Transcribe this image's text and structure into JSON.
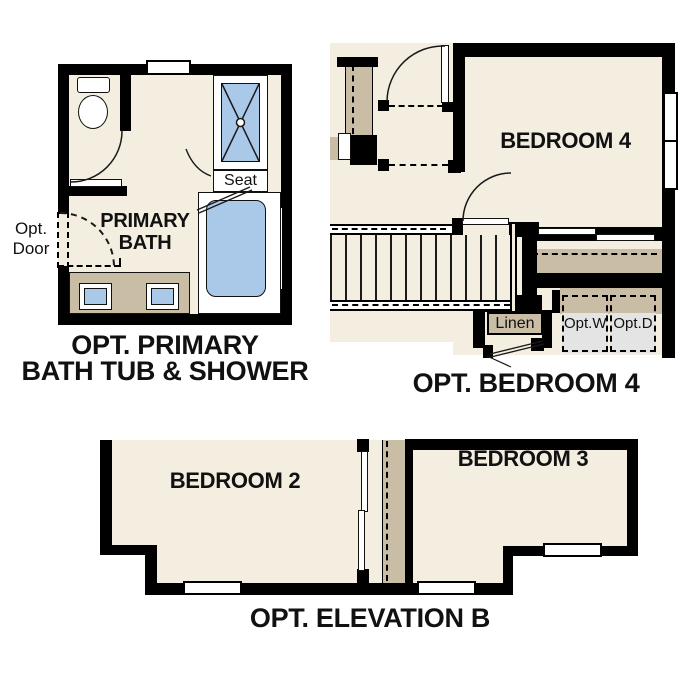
{
  "colors": {
    "floor": "#f4eee1",
    "counter": "#c9bda6",
    "fixture": "#aac8e8",
    "appliance": "#e4e4e4",
    "wall": "#000000"
  },
  "bath": {
    "caption1": "OPT. PRIMARY",
    "caption2": "BATH TUB & SHOWER",
    "room1": "PRIMARY",
    "room2": "BATH",
    "seat": "Seat",
    "opt_door1": "Opt.",
    "opt_door2": "Door"
  },
  "bedroom4": {
    "caption": "OPT. BEDROOM 4",
    "room": "BEDROOM 4",
    "linen": "Linen",
    "washer1": "Opt.",
    "washer2": "W",
    "dryer1": "Opt.",
    "dryer2": "D"
  },
  "elevation": {
    "caption": "OPT. ELEVATION B",
    "bedroom2": "BEDROOM 2",
    "bedroom3": "BEDROOM 3"
  }
}
